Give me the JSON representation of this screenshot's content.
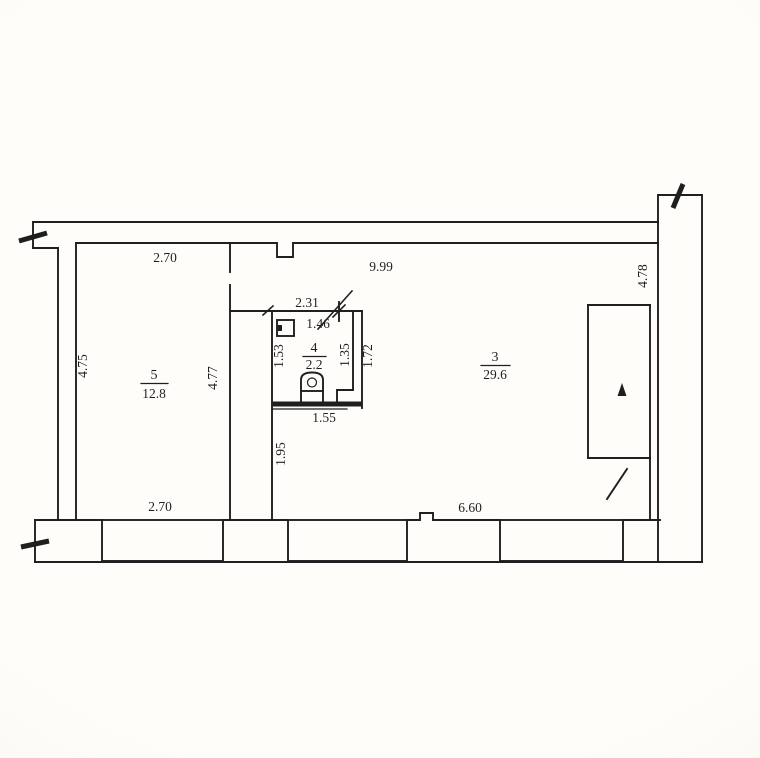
{
  "plan": {
    "type": "floor-plan",
    "rooms": {
      "room5": {
        "number": "5",
        "area": "12.8"
      },
      "room4": {
        "number": "4",
        "area": "2.2"
      },
      "room3": {
        "number": "3",
        "area": "29.6"
      }
    },
    "dims": {
      "room5_top_width": "2.70",
      "room3_top_width": "9.99",
      "stairwell_height": "4.78",
      "bath_overall_width": "2.31",
      "bath_inner_width": "1.46",
      "bath_left_height": "1.53",
      "bath_right_inner_height": "1.35",
      "bath_right_outer_height": "1.72",
      "room5_left_height": "4.75",
      "room5_right_wall_height": "4.77",
      "bath_bottom_width": "1.55",
      "below_bath_wall_height": "1.95",
      "room5_bottom_width": "2.70",
      "room3_bottom_width": "6.60"
    },
    "colors": {
      "ink": "#1f1f1f",
      "paper": "#fcfaf3"
    }
  }
}
